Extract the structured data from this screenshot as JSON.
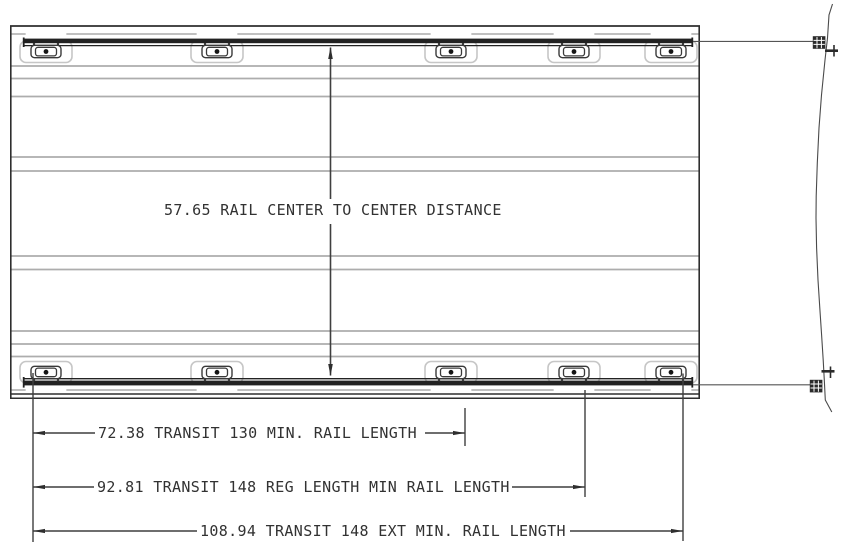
{
  "drawing": {
    "title": "Van roof rail layout drawing",
    "center_dimension": {
      "value": "57.65",
      "label": "RAIL CENTER TO CENTER DISTANCE",
      "text": "57.65 RAIL CENTER TO CENTER DISTANCE"
    },
    "length_dimensions": [
      {
        "value": "72.38",
        "label": "TRANSIT 130 MIN. RAIL LENGTH",
        "text": "72.38 TRANSIT 130 MIN. RAIL LENGTH"
      },
      {
        "value": "92.81",
        "label": "TRANSIT 148 REG LENGTH MIN RAIL LENGTH",
        "text": "92.81 TRANSIT 148 REG LENGTH MIN RAIL LENGTH"
      },
      {
        "value": "108.94",
        "label": "TRANSIT 148 EXT MIN. RAIL LENGTH",
        "text": "108.94 TRANSIT 148 EXT MIN. RAIL LENGTH"
      }
    ],
    "colors": {
      "line_dark": "#2e2e2e",
      "line_medium": "#555555",
      "rib_gray": "#adadad",
      "pocket_gray": "#c6c6c6",
      "background": "#ffffff"
    }
  }
}
